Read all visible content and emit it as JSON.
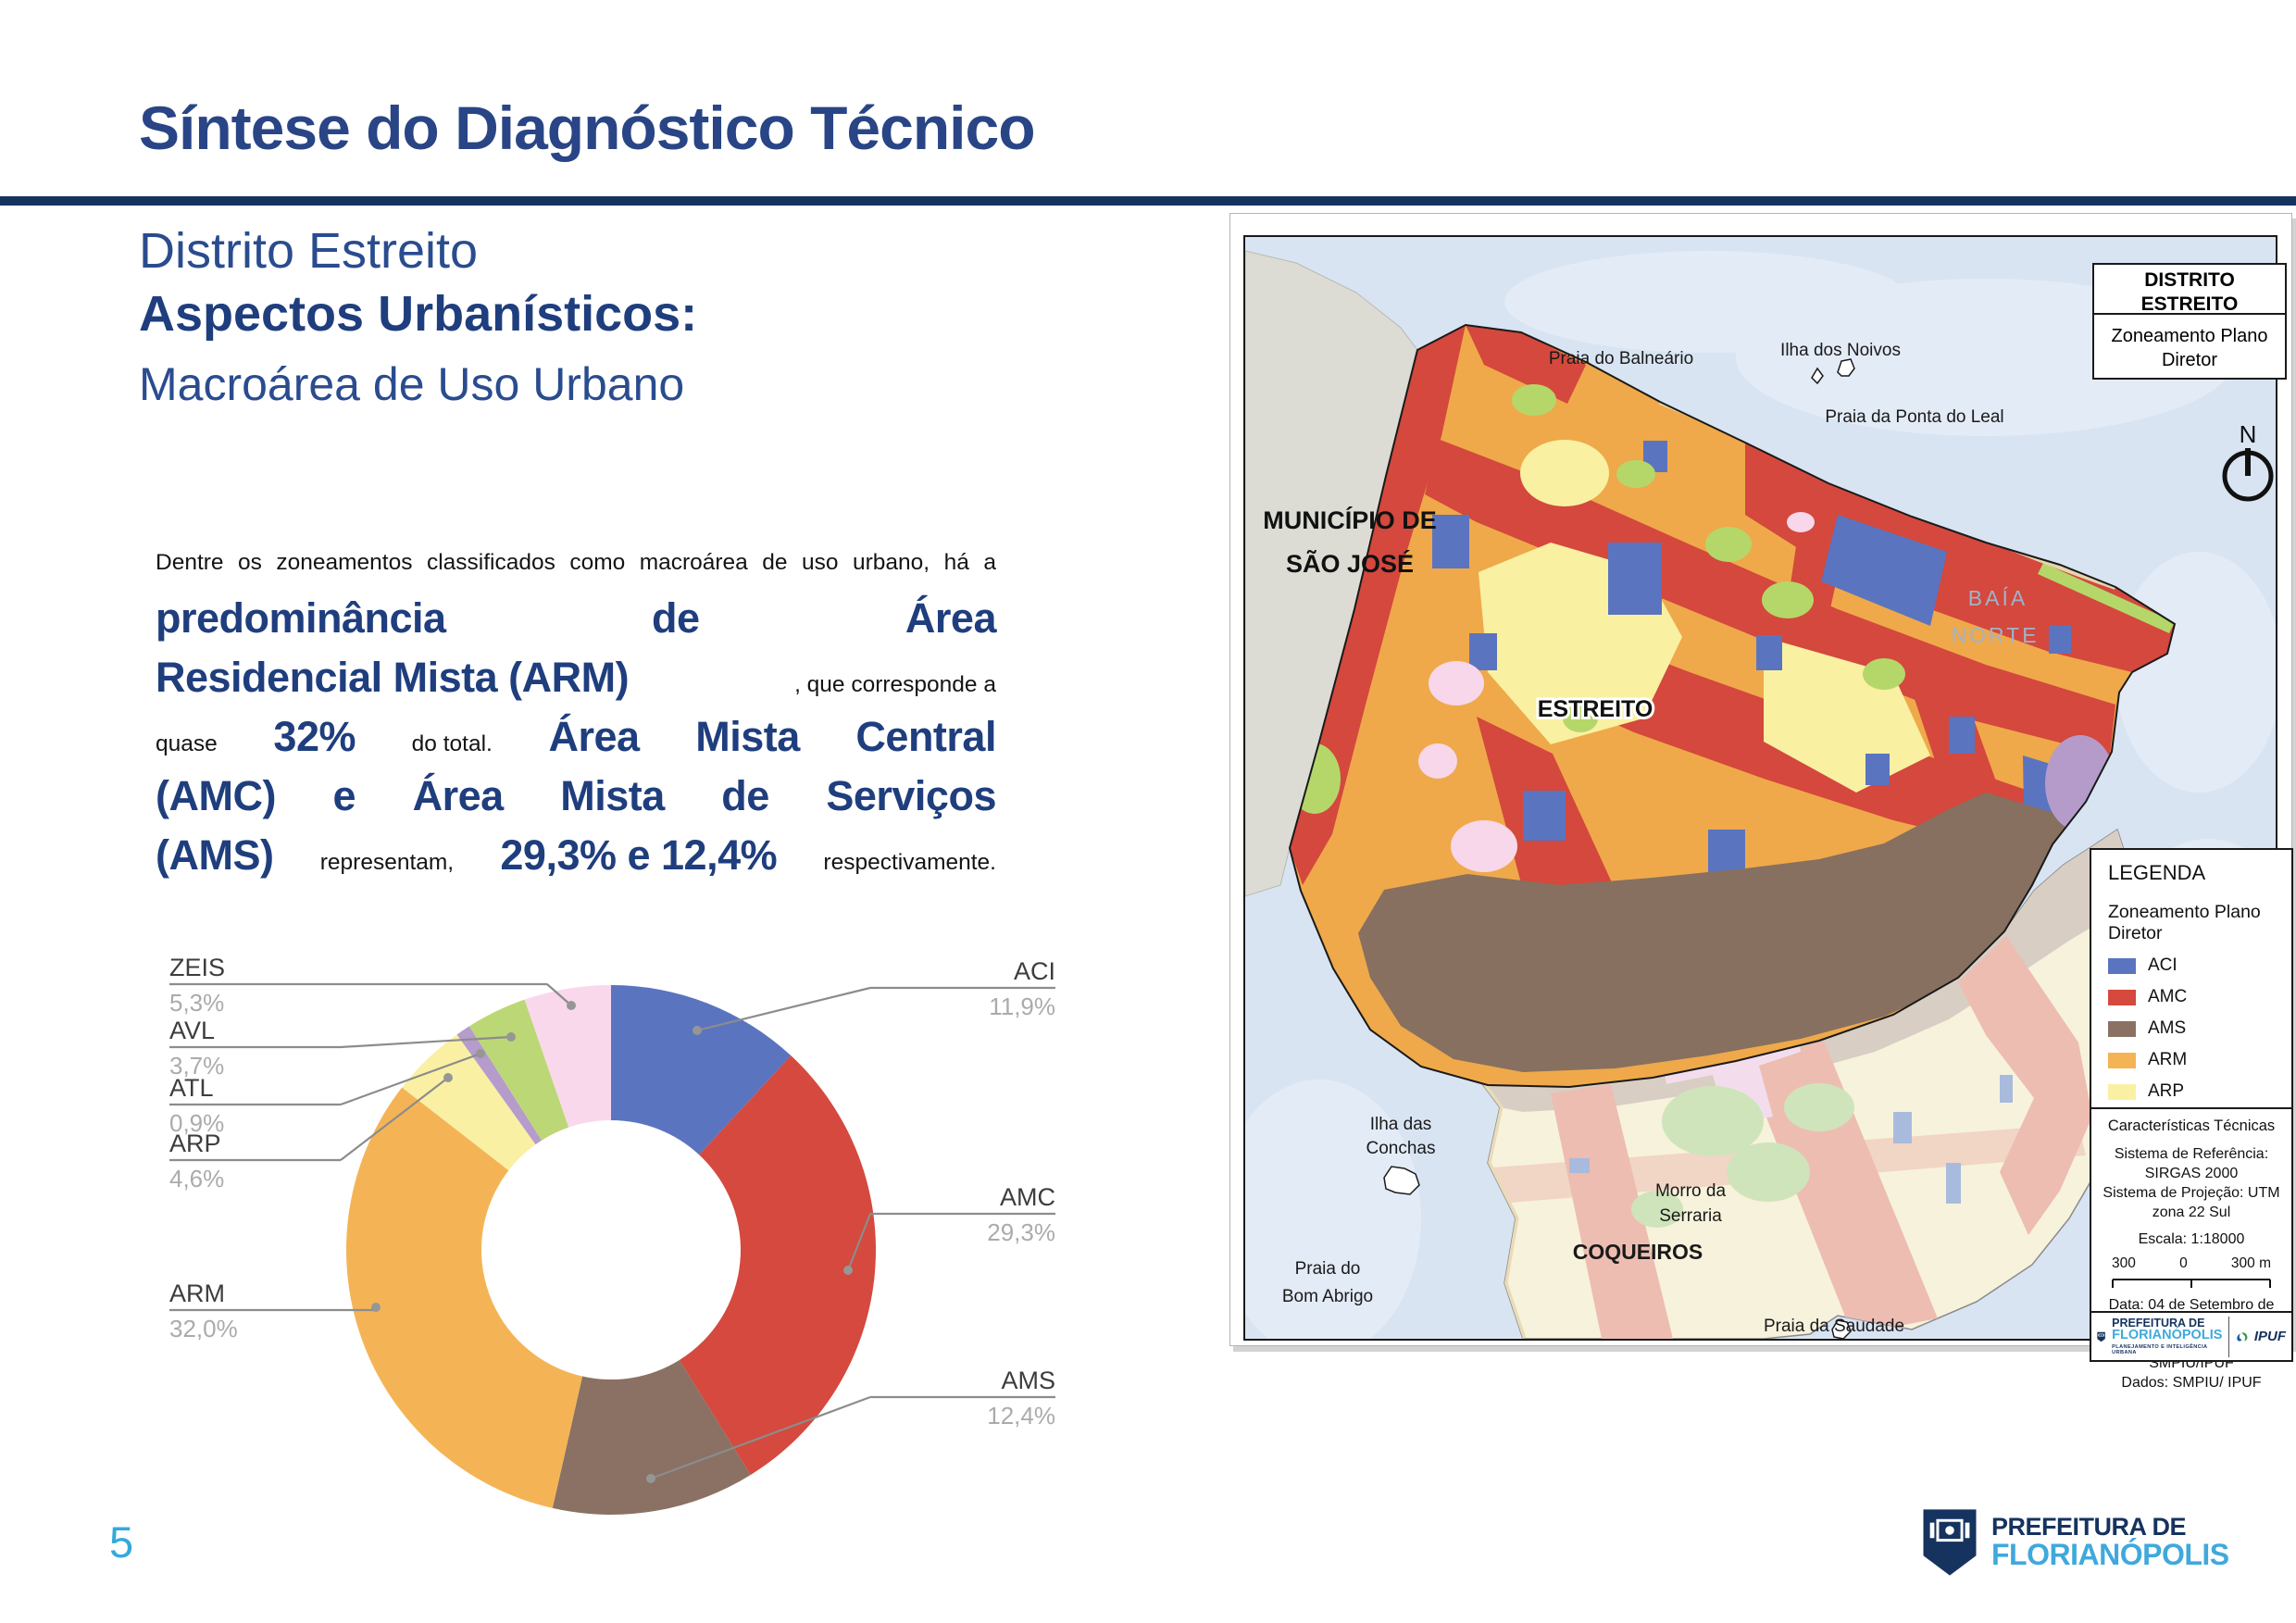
{
  "header": {
    "title": "Síntese do Diagnóstico Técnico",
    "subtitle1": "Distrito Estreito",
    "subtitle2": "Aspectos Urbanísticos:",
    "subtitle3": "Macroárea de Uso Urbano"
  },
  "page": {
    "number": "5"
  },
  "paragraph": {
    "lines": [
      [
        {
          "t": "Dentre",
          "s": "s"
        },
        {
          "t": "os",
          "s": "s"
        },
        {
          "t": "zoneamentos",
          "s": "s"
        },
        {
          "t": "classificados",
          "s": "s"
        },
        {
          "t": "como",
          "s": "s"
        },
        {
          "t": "macroárea",
          "s": "s"
        },
        {
          "t": "de",
          "s": "s"
        },
        {
          "t": "uso",
          "s": "s"
        },
        {
          "t": "urbano,",
          "s": "s"
        },
        {
          "t": "há",
          "s": "s"
        },
        {
          "t": "a",
          "s": "s"
        }
      ],
      [
        {
          "t": "predominância",
          "s": "b"
        },
        {
          "t": "de",
          "s": "b"
        },
        {
          "t": "Área",
          "s": "b"
        }
      ],
      [
        {
          "t": "Residencial Mista (ARM)",
          "s": "b"
        },
        {
          "t": ", que corresponde a",
          "s": "s"
        }
      ],
      [
        {
          "t": "quase",
          "s": "s"
        },
        {
          "t": "32%",
          "s": "b"
        },
        {
          "t": "do total.",
          "s": "s"
        },
        {
          "t": "Área",
          "s": "b"
        },
        {
          "t": "Mista",
          "s": "b"
        },
        {
          "t": "Central",
          "s": "b"
        }
      ],
      [
        {
          "t": "(AMC)",
          "s": "b"
        },
        {
          "t": "e",
          "s": "b"
        },
        {
          "t": "Área",
          "s": "b"
        },
        {
          "t": "Mista",
          "s": "b"
        },
        {
          "t": "de",
          "s": "b"
        },
        {
          "t": "Serviços",
          "s": "b"
        }
      ],
      [
        {
          "t": "(AMS)",
          "s": "b"
        },
        {
          "t": "representam,",
          "s": "s"
        },
        {
          "t": "29,3% e 12,4%",
          "s": "b"
        },
        {
          "t": "respectivamente.",
          "s": "s"
        }
      ]
    ]
  },
  "chart_data": {
    "type": "pie",
    "subtype": "donut",
    "start": "top-clockwise",
    "slices": [
      {
        "label": "ACI",
        "value": 11.9,
        "display": "11,9%",
        "color": "#5B74C0"
      },
      {
        "label": "AMC",
        "value": 29.3,
        "display": "29,3%",
        "color": "#D5493E"
      },
      {
        "label": "AMS",
        "value": 12.4,
        "display": "12,4%",
        "color": "#8A7164"
      },
      {
        "label": "ARM",
        "value": 32.0,
        "display": "32,0%",
        "color": "#F4B456"
      },
      {
        "label": "ARP",
        "value": 4.6,
        "display": "4,6%",
        "color": "#FAF0A4"
      },
      {
        "label": "ATL",
        "value": 0.9,
        "display": "0,9%",
        "color": "#B59CCB"
      },
      {
        "label": "AVL",
        "value": 3.7,
        "display": "3,7%",
        "color": "#BCD876"
      },
      {
        "label": "ZEIS",
        "value": 5.3,
        "display": "5,3%",
        "color": "#F9D8EC"
      }
    ]
  },
  "map": {
    "frame": {
      "title_line1": "DISTRITO",
      "title_line2": "ESTREITO",
      "subtitle": "Zoneamento Plano Diretor",
      "north": "N"
    },
    "labels": {
      "municipio1": "MUNICÍPIO DE",
      "municipio2": "SÃO JOSÉ",
      "praia_balneario": "Praia do Balneário",
      "ilha_noivos": "Ilha dos Noivos",
      "praia_ponta_leal": "Praia da Ponta do Leal",
      "baia1": "BAÍA",
      "baia2": "NORTE",
      "estreito": "ESTREITO",
      "ilha_conchas1": "Ilha das",
      "ilha_conchas2": "Conchas",
      "praia_bom_abrigo1": "Praia do",
      "praia_bom_abrigo2": "Bom Abrigo",
      "morro1": "Morro da",
      "morro2": "Serraria",
      "coqueiros": "COQUEIROS",
      "praia_saudade": "Praia da Saudade",
      "praia_riso": "Praia do Riso"
    },
    "legend": {
      "title": "LEGENDA",
      "subtitle": "Zoneamento Plano Diretor",
      "items": [
        {
          "label": "ACI",
          "color": "#5B74C0"
        },
        {
          "label": "AMC",
          "color": "#D5493E"
        },
        {
          "label": "AMS",
          "color": "#8A7164"
        },
        {
          "label": "ARM",
          "color": "#F4B456"
        },
        {
          "label": "ARP",
          "color": "#FAF0A4"
        },
        {
          "label": "ATL",
          "color": "#B59CCB"
        },
        {
          "label": "AVL",
          "color": "#BCD876"
        },
        {
          "label": "ZEIS",
          "color": "#F9D8EC"
        }
      ]
    },
    "tech": {
      "title": "Características Técnicas",
      "line1": "Sistema de Referência: SIRGAS 2000",
      "line2": "Sistema de Projeção: UTM zona 22 Sul",
      "escala": "Escala: 1:18000",
      "scale_left": "300",
      "scale_mid": "0",
      "scale_right": "300 m",
      "data": "Data: 04 de Setembro de 2024",
      "elaborado": "Elaborado por GPLAN | SMPIU/IPUF",
      "dados": "Dados: SMPIU/ IPUF"
    },
    "logos": {
      "pref_line1": "PREFEITURA DE",
      "pref_line2": "FLORIANÓPOLIS",
      "pref_tagline": "PLANEJAMENTO E INTELIGÊNCIA URBANA",
      "ipuf": "IPUF"
    }
  },
  "footer_logo": {
    "line1": "PREFEITURA DE",
    "line2": "FLORIANÓPOLIS"
  },
  "colors": {
    "navy": "#16325F",
    "heading_blue": "#294586",
    "bold_blue": "#1F3E7E",
    "cyan": "#3FA9DC",
    "water": "#D8E4F2",
    "gray_land": "#DCDCD5",
    "label_gray": "#3d3d3d",
    "pct_gray": "#ABABAB"
  }
}
